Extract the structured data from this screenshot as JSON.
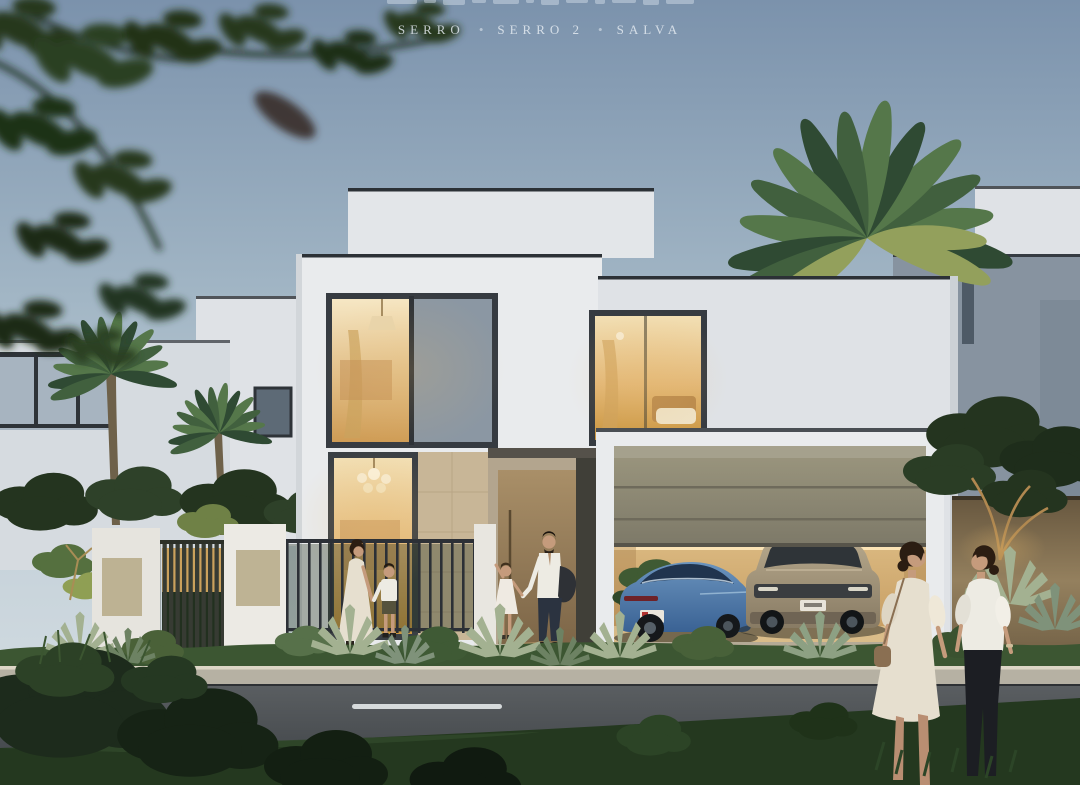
{
  "header": {
    "project_names": [
      "SERRO",
      "SERRO 2",
      "SALVA"
    ],
    "separator": "•"
  },
  "palette": {
    "sky-top": "#7b92ac",
    "sky-mid": "#a2b6c5",
    "sky-low": "#ccd7de",
    "wall": "#e9ebed",
    "wall-2": "#dfe2e6",
    "frame-dark": "#33383e",
    "warm-hi": "#f2dfb4",
    "warm-lo": "#c9953f",
    "glass-gray": "#8b97a3",
    "stone": "#c8b697",
    "door-bronze": "#9a8260",
    "garage-door": "#8d8875",
    "garage-interior": "#e2bc80",
    "car-blue": "#4c7bab",
    "suv-tan": "#a79a80",
    "road": "#4a4e52",
    "curb": "#b6b1a3",
    "lane": "#d6dadb",
    "hedge": "#3c5632",
    "hedge-lit": "#7e9450",
    "agave": "#a3b191",
    "foliage": "#24341f",
    "grass": "#24381f",
    "trunk": "#6e614a",
    "neighbor-gray": "#8793a0",
    "warm-wall": "#8a775a",
    "dress-cream": "#e6dfcf",
    "shirt-white": "#edebe3",
    "pants-dark": "#1c1e23",
    "skin": "#c59b7c",
    "hair": "#2b1d12",
    "text-light": "#e7edf3"
  },
  "scene": {
    "setting": "modern two-storey villa exterior at dusk with lit interiors and open garage",
    "vehicles": [
      {
        "name": "blue sports car"
      },
      {
        "name": "beige suv"
      }
    ],
    "people_count": 6
  }
}
